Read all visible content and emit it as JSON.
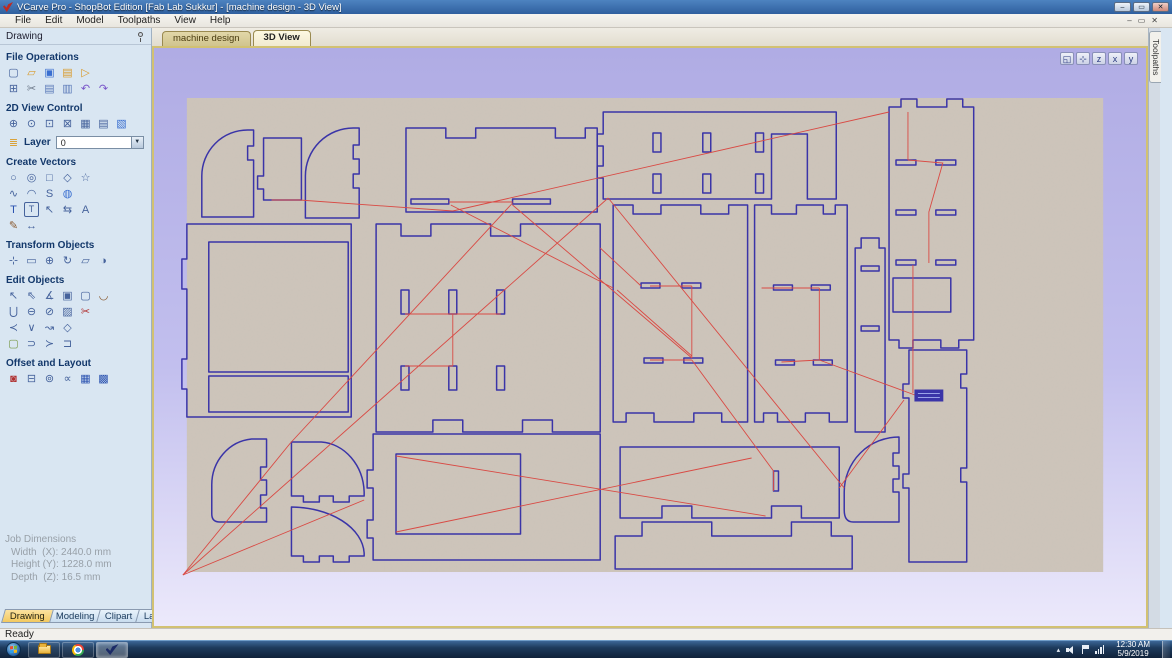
{
  "window": {
    "title": "VCarve Pro - ShopBot Edition [Fab Lab Sukkur] - [machine design - 3D View]",
    "controls": [
      {
        "name": "minimize",
        "g": "–"
      },
      {
        "name": "restore",
        "g": "▭"
      },
      {
        "name": "close",
        "g": "✕"
      }
    ]
  },
  "menu": {
    "items": [
      "File",
      "Edit",
      "Model",
      "Toolpaths",
      "View",
      "Help"
    ],
    "mdi_controls": [
      {
        "name": "mdi-minimize",
        "g": "–"
      },
      {
        "name": "mdi-restore",
        "g": "▭"
      },
      {
        "name": "mdi-close",
        "g": "✕"
      }
    ]
  },
  "toolbox": {
    "title": "Drawing",
    "file_operations": {
      "title": "File Operations",
      "rows": [
        [
          {
            "name": "new-file",
            "g": "▢"
          },
          {
            "name": "open-file",
            "g": "▱",
            "c": "#d99a2b"
          },
          {
            "name": "save-file",
            "g": "▣",
            "c": "#3a6fd0"
          },
          {
            "name": "import-vectors",
            "g": "▤",
            "c": "#d99a2b"
          },
          {
            "name": "export-vectors",
            "g": "▷",
            "c": "#d99a2b"
          }
        ],
        [
          {
            "name": "select-all",
            "g": "⊞"
          },
          {
            "name": "cut",
            "g": "✂",
            "c": "#6b7788"
          },
          {
            "name": "copy",
            "g": "▤",
            "c": "#5a79b8"
          },
          {
            "name": "paste",
            "g": "▥",
            "c": "#5a79b8"
          },
          {
            "name": "undo",
            "g": "↶",
            "c": "#7753c8"
          },
          {
            "name": "redo",
            "g": "↷",
            "c": "#7753c8"
          }
        ]
      ]
    },
    "view_control": {
      "title": "2D View Control",
      "rows": [
        [
          {
            "name": "pan-view",
            "g": "⊕"
          },
          {
            "name": "zoom-interactive",
            "g": "⊙"
          },
          {
            "name": "zoom-box",
            "g": "⊡"
          },
          {
            "name": "zoom-selected",
            "g": "⊠"
          },
          {
            "name": "zoom-drawing",
            "g": "▦"
          },
          {
            "name": "zoom-material",
            "g": "▤"
          },
          {
            "name": "toggle-3d-view",
            "g": "▧",
            "c": "#3a6fd0"
          }
        ]
      ]
    },
    "layer": {
      "label": "Layer",
      "value": "0",
      "dropdown_icon": "▼",
      "icon_glyph": "≣"
    },
    "create_vectors": {
      "title": "Create Vectors",
      "rows": [
        [
          {
            "name": "draw-circle",
            "g": "○"
          },
          {
            "name": "draw-ellipse",
            "g": "◎"
          },
          {
            "name": "draw-rectangle",
            "g": "□"
          },
          {
            "name": "draw-polygon",
            "g": "◇"
          },
          {
            "name": "draw-star",
            "g": "☆"
          }
        ],
        [
          {
            "name": "draw-polyline",
            "g": "∿"
          },
          {
            "name": "draw-arc",
            "g": "◠"
          },
          {
            "name": "draw-curve",
            "g": "S"
          },
          {
            "name": "draw-spiral",
            "g": "◍",
            "c": "#3a6fd0"
          }
        ],
        [
          {
            "name": "draw-text",
            "g": "T",
            "c": "#2a52b0"
          },
          {
            "name": "draw-text-box",
            "g": "T",
            "b": true
          },
          {
            "name": "select-text",
            "g": "↖"
          },
          {
            "name": "text-spacing",
            "g": "⇆"
          },
          {
            "name": "convert-text",
            "g": "A"
          }
        ],
        [
          {
            "name": "vector-texture",
            "g": "✎",
            "c": "#8a5a30"
          },
          {
            "name": "dimension",
            "g": "↔"
          }
        ]
      ]
    },
    "transform_objects": {
      "title": "Transform Objects",
      "rows": [
        [
          {
            "name": "move-selection",
            "g": "⊹"
          },
          {
            "name": "set-size",
            "g": "▭"
          },
          {
            "name": "center-in-material",
            "g": "⊕"
          },
          {
            "name": "rotate",
            "g": "↻"
          },
          {
            "name": "distort",
            "g": "▱"
          },
          {
            "name": "mirror",
            "g": "◑"
          }
        ]
      ]
    },
    "edit_objects": {
      "title": "Edit Objects",
      "rows": [
        [
          {
            "name": "select-vectors",
            "g": "↖"
          },
          {
            "name": "node-edit",
            "g": "⇖"
          },
          {
            "name": "measure",
            "g": "∡"
          },
          {
            "name": "group",
            "g": "▣"
          },
          {
            "name": "ungroup",
            "g": "▢"
          },
          {
            "name": "fillet",
            "g": "◡",
            "c": "#8a5a30"
          }
        ],
        [
          {
            "name": "weld",
            "g": "⋃"
          },
          {
            "name": "subtract",
            "g": "⊖"
          },
          {
            "name": "trim-overlap",
            "g": "⊘"
          },
          {
            "name": "vector-validator",
            "g": "▨"
          },
          {
            "name": "scissors-trim",
            "g": "✂",
            "c": "#b03030"
          }
        ],
        [
          {
            "name": "join-open-vectors",
            "g": "≺"
          },
          {
            "name": "close-vector",
            "g": "∨"
          },
          {
            "name": "fit-curve",
            "g": "↝"
          },
          {
            "name": "extend",
            "g": "◇"
          }
        ],
        [
          {
            "name": "create-outline",
            "g": "▢",
            "c": "#7a9a4a"
          },
          {
            "name": "bridge-open",
            "g": "⊃"
          },
          {
            "name": "bridge-close",
            "g": "≻"
          },
          {
            "name": "smart-join",
            "g": "⊐"
          }
        ]
      ]
    },
    "offset_layout": {
      "title": "Offset and Layout",
      "rows": [
        [
          {
            "name": "offset-vectors",
            "g": "◙",
            "c": "#b03030"
          },
          {
            "name": "array-copy",
            "g": "⊟"
          },
          {
            "name": "circular-copy",
            "g": "⊚"
          },
          {
            "name": "copy-along-vectors",
            "g": "∝"
          },
          {
            "name": "nesting",
            "g": "▦",
            "c": "#2a52b0"
          },
          {
            "name": "true-shape-nesting",
            "g": "▩",
            "c": "#2a52b0"
          }
        ]
      ]
    },
    "job_dimensions": {
      "title": "Job Dimensions",
      "lines": [
        {
          "label": "Width  (X):",
          "value": "2440.0 mm"
        },
        {
          "label": "Height (Y):",
          "value": "1228.0 mm"
        },
        {
          "label": "Depth  (Z):",
          "value": "16.5 mm"
        }
      ]
    },
    "tabs": [
      {
        "label": "Drawing",
        "active": true
      },
      {
        "label": "Modeling",
        "active": false
      },
      {
        "label": "Clipart",
        "active": false
      },
      {
        "label": "Layers",
        "active": false
      }
    ]
  },
  "main": {
    "doc_tabs": [
      {
        "label": "machine design",
        "active": false
      },
      {
        "label": "3D View",
        "active": true
      }
    ],
    "view_buttons": [
      {
        "name": "toggle-2d-3d-window",
        "g": "◱"
      },
      {
        "name": "isometric-view",
        "g": "⊹"
      },
      {
        "name": "view-down-z",
        "g": "z"
      },
      {
        "name": "view-along-x",
        "g": "x"
      },
      {
        "name": "view-along-y",
        "g": "y"
      }
    ],
    "toolpaths_tab": "Toolpaths"
  },
  "statusbar": {
    "text": "Ready"
  },
  "taskbar": {
    "apps": [
      "start",
      "explorer",
      "chrome",
      "vcarve"
    ],
    "clock": {
      "time": "12:30 AM",
      "date": "5/9/2019"
    }
  },
  "colors": {
    "titlebar_top": "#4d83c0",
    "titlebar_bottom": "#2f5f9e",
    "menubar_bg": "#e9e6df",
    "sidebar_bg": "#d9e6f2",
    "section_title": "#13386b",
    "icon_blue": "#46639c",
    "canvas_top": "#b0ace4",
    "canvas_border": "#d2c172",
    "board_tan": "#cec5bb",
    "vector_blue": "#3a34a8",
    "toolpath_red": "#d94a44",
    "tab_active": "#f3c95f",
    "tab_inactive": "#c8dcee",
    "doc_tab_active": "#f1ead0",
    "doc_tab_inactive": "#d0c48e",
    "statusbar": "#f2f0ec",
    "taskbar_top": "#3c6697",
    "taskbar_bottom": "#10223a",
    "job_dim_text": "#98a0a8"
  }
}
